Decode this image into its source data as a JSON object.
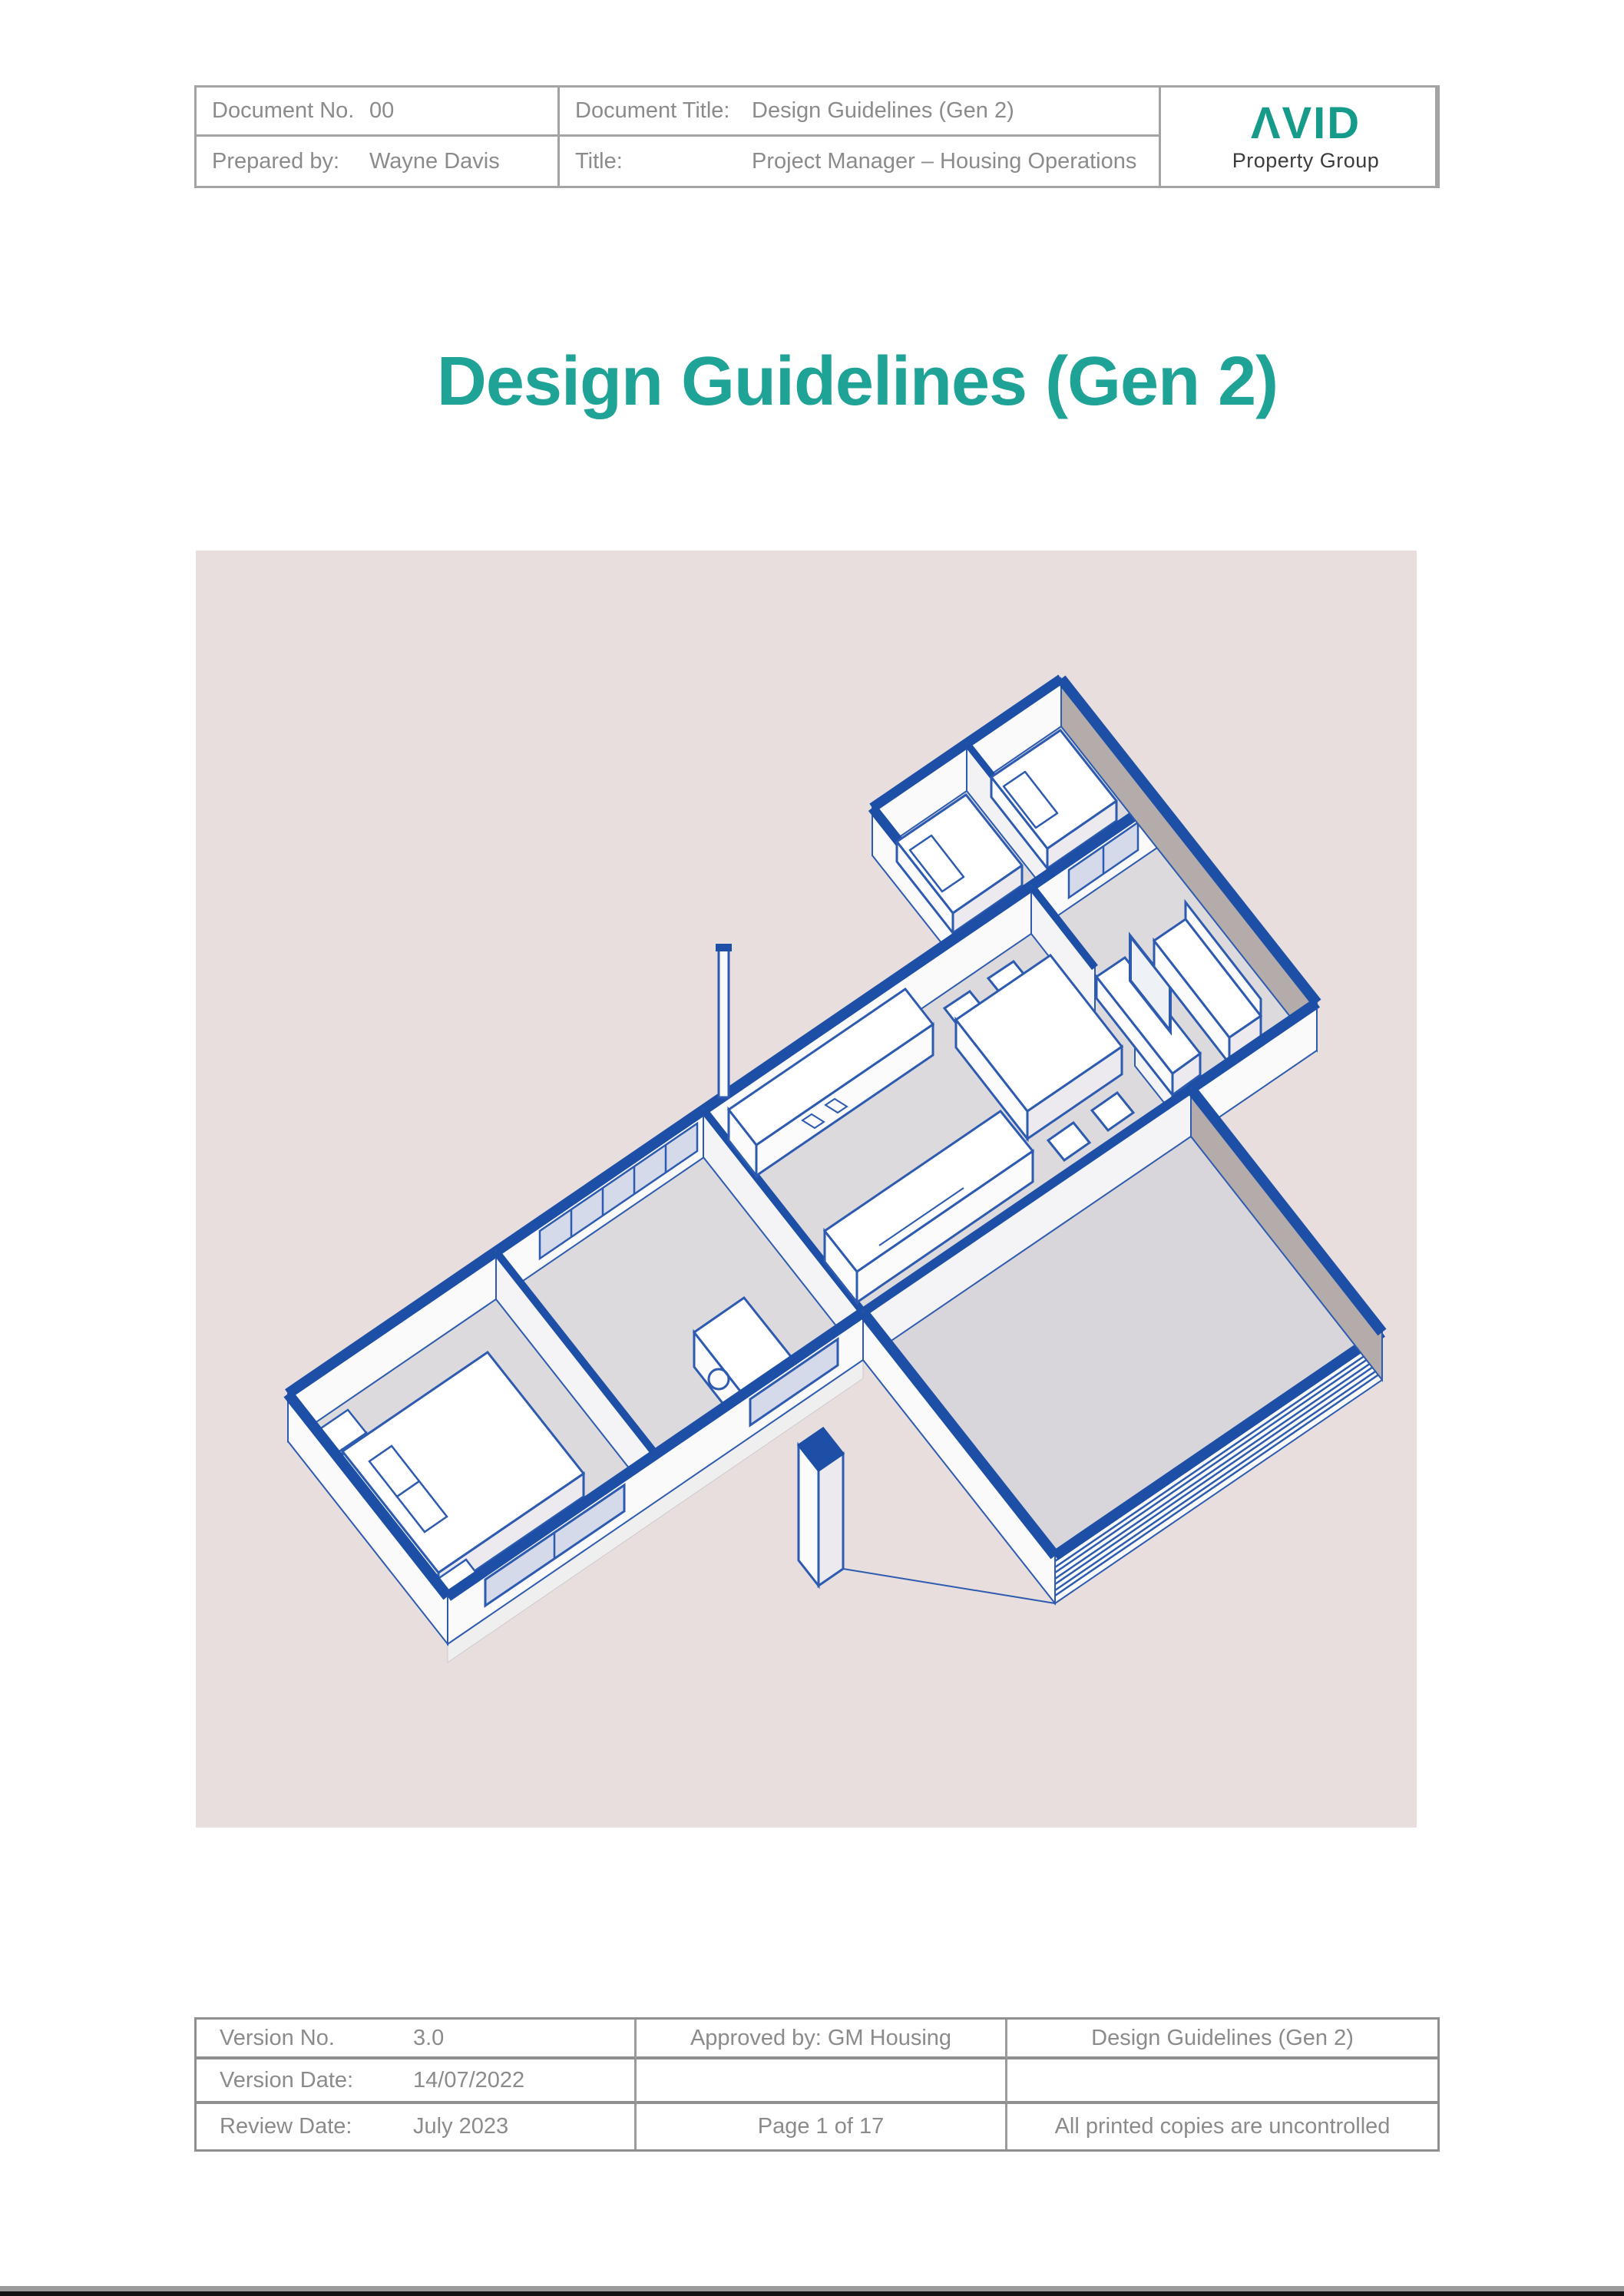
{
  "document": {
    "title_block": {
      "row1": {
        "label1": "Document No.",
        "value1": "00",
        "label2": "Document Title:",
        "value2": "Design Guidelines (Gen 2)"
      },
      "row2": {
        "label1": "Prepared by:",
        "value1": "Wayne Davis",
        "label2": "Title:",
        "value2": "Project Manager – Housing Operations"
      }
    },
    "logo": {
      "wordmark": "ΛVID",
      "tagline": "Property Group",
      "accent_color": "#169b8b"
    },
    "main_title": "Design Guidelines (Gen 2)",
    "main_title_color": "#1fa396",
    "cover_image": {
      "description": "Blue 3D isometric cutaway floor plan rendering of a single-storey house with bedrooms, kitchen, dining, living room and garage, on a pale pink background",
      "background": "#e7dedd",
      "line_color": "#1d4fa6"
    },
    "footer_block": {
      "row1": {
        "label": "Version No.",
        "value": "3.0",
        "center": "Approved by: GM Housing",
        "right": "Design Guidelines (Gen 2)"
      },
      "row2": {
        "label": "Version Date:",
        "value": "14/07/2022",
        "center": "",
        "right": ""
      },
      "row3": {
        "label": "Review Date:",
        "value": "July 2023",
        "center": "Page 1 of 17",
        "right": "All printed copies are uncontrolled"
      }
    }
  }
}
